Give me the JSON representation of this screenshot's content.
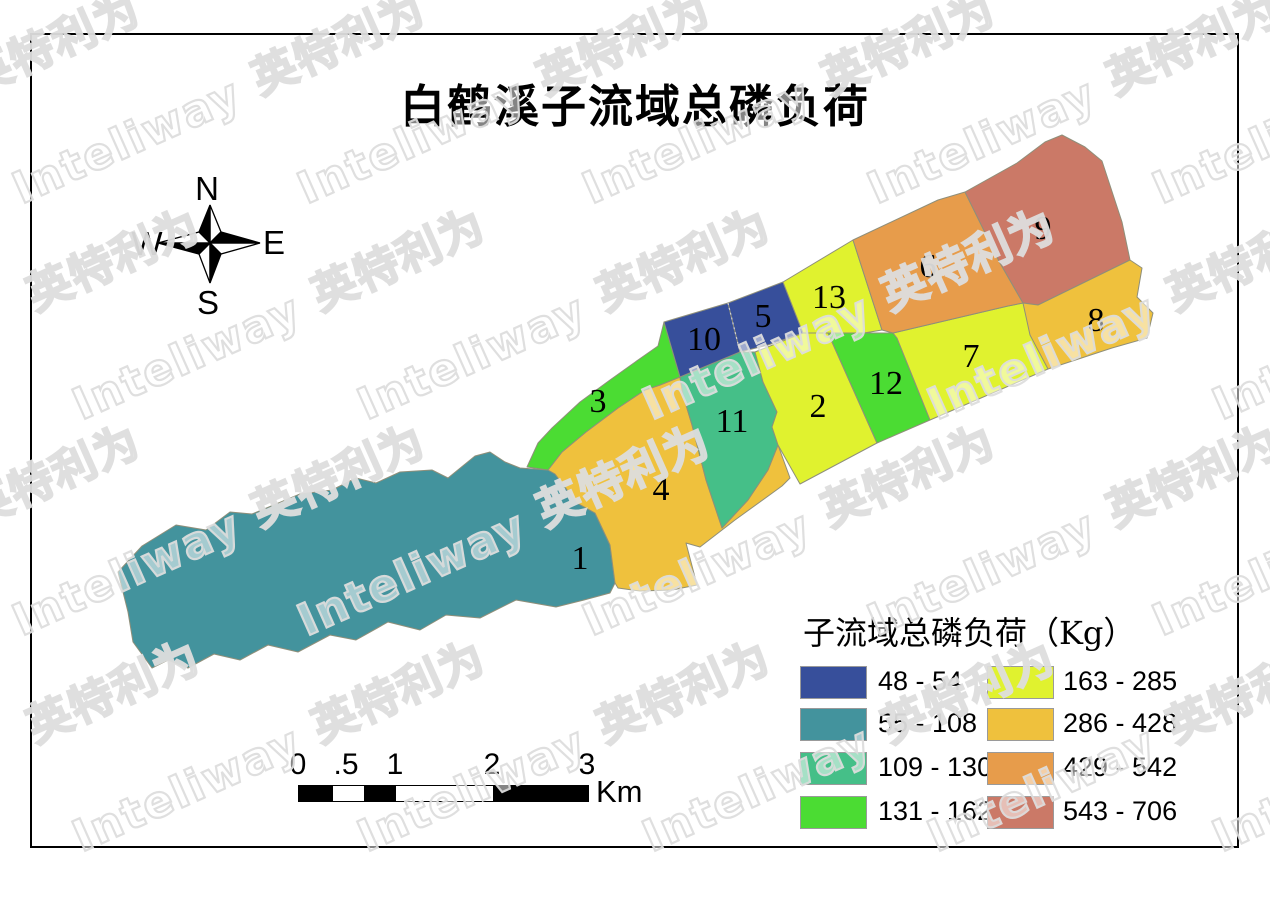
{
  "title": "白鹤溪子流域总磷负荷",
  "watermark": {
    "cn": "英特利为",
    "en": "Inteliway"
  },
  "compass": {
    "n": "N",
    "e": "E",
    "s": "S",
    "w": "W"
  },
  "map": {
    "regions": [
      {
        "label": "1",
        "range": "55 - 108",
        "color_class": 1
      },
      {
        "label": "2",
        "range": "163 - 285",
        "color_class": 4
      },
      {
        "label": "3",
        "range": "131 - 162",
        "color_class": 3
      },
      {
        "label": "4",
        "range": "286 - 428",
        "color_class": 5
      },
      {
        "label": "5",
        "range": "48 - 54",
        "color_class": 0
      },
      {
        "label": "6",
        "range": "429 - 542",
        "color_class": 6
      },
      {
        "label": "7",
        "range": "163 - 285",
        "color_class": 4
      },
      {
        "label": "8",
        "range": "286 - 428",
        "color_class": 5
      },
      {
        "label": "9",
        "range": "543 - 706",
        "color_class": 7
      },
      {
        "label": "10",
        "range": "48 - 54",
        "color_class": 0
      },
      {
        "label": "11",
        "range": "109 - 130",
        "color_class": 2
      },
      {
        "label": "12",
        "range": "131 - 162",
        "color_class": 3
      },
      {
        "label": "13",
        "range": "163 - 285",
        "color_class": 4
      }
    ]
  },
  "legend": {
    "title": "子流域总磷负荷（Kg）",
    "classes": [
      {
        "label": "48 - 54",
        "color": "#374F9B"
      },
      {
        "label": "55 - 108",
        "color": "#43939D"
      },
      {
        "label": "109 - 130",
        "color": "#45BF88"
      },
      {
        "label": "131 - 162",
        "color": "#4BDC33"
      },
      {
        "label": "163 - 285",
        "color": "#E0F22F"
      },
      {
        "label": "286 - 428",
        "color": "#EFC13D"
      },
      {
        "label": "429 - 542",
        "color": "#E79C4B"
      },
      {
        "label": "543 - 706",
        "color": "#CB7967"
      }
    ]
  },
  "scalebar": {
    "ticks": [
      "0",
      ".5",
      "1",
      "2",
      "3"
    ],
    "unit": "Km"
  }
}
